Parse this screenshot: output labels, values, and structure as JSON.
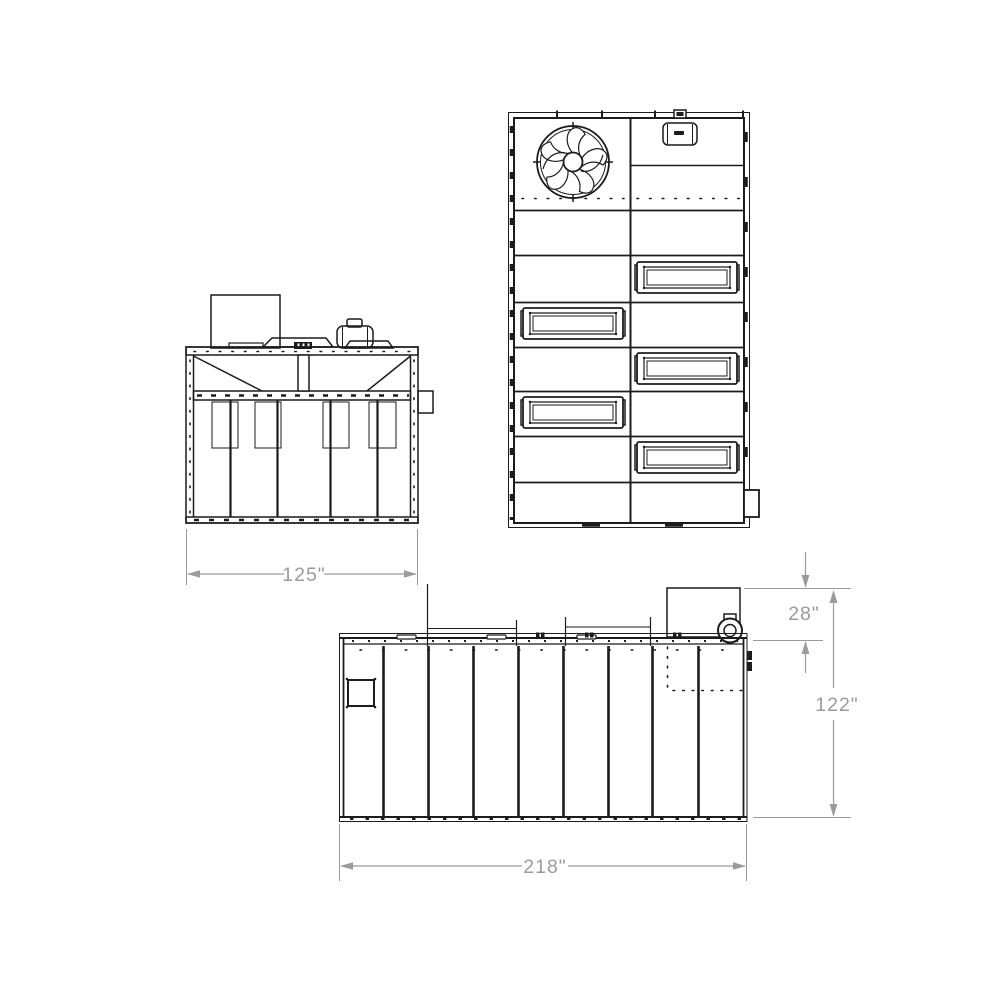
{
  "drawing": {
    "type": "technical-drawing",
    "views": [
      {
        "id": "front-view",
        "filter_cartridges": 4
      },
      {
        "id": "top-view",
        "access_hatches": 5
      },
      {
        "id": "side-view",
        "panel_seams": 8
      }
    ],
    "dimensions": {
      "front_width": "125\"",
      "fan_stack_height": "28\"",
      "overall_height": "122\"",
      "side_length": "218\""
    },
    "colors": {
      "line": "#1c1c1c",
      "dimension": "#9b9b9b",
      "background": "#ffffff"
    }
  }
}
